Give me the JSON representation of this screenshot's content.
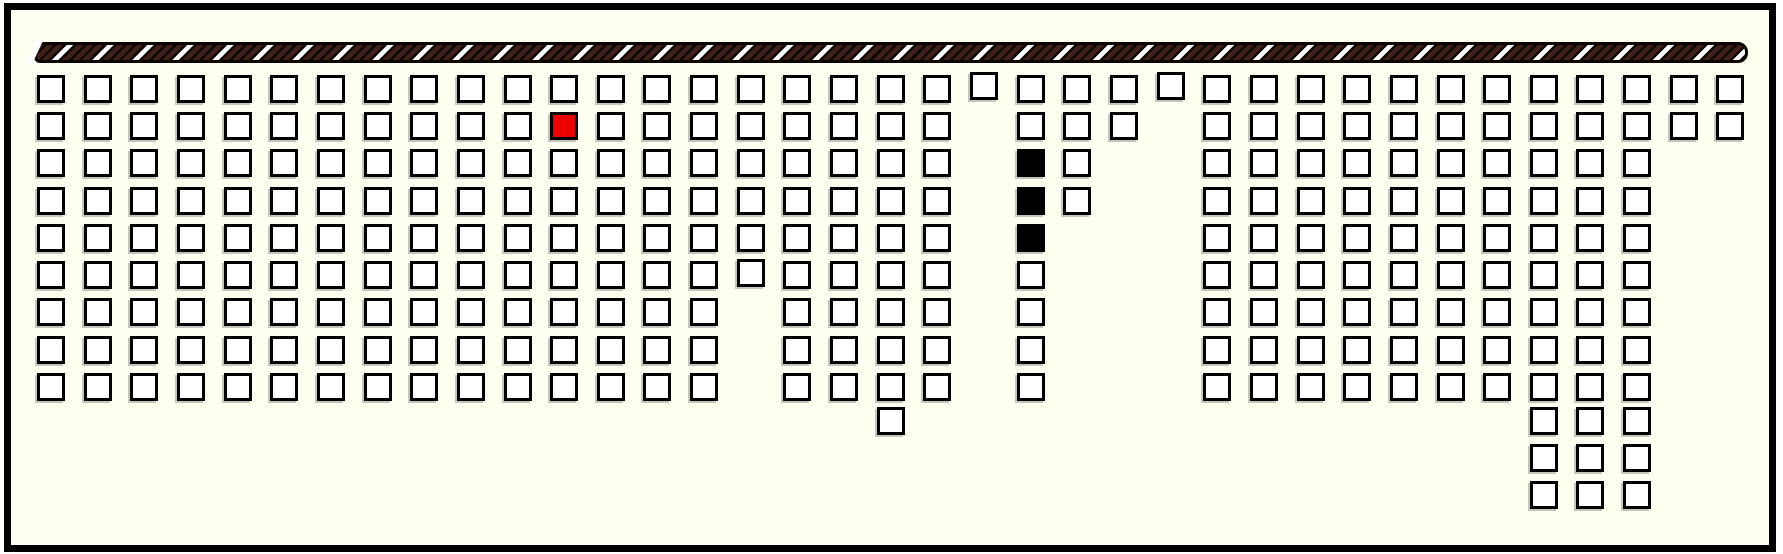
{
  "canvas": {
    "width": 1783,
    "height": 554,
    "outer_background": "#ffffff"
  },
  "frame": {
    "x": 4,
    "y": 3,
    "width": 1772,
    "height": 549,
    "border_color": "#000000",
    "border_width": 7,
    "fill": "#fffff1"
  },
  "hatched_bar": {
    "x": 34,
    "y": 42,
    "width": 1714,
    "height": 21,
    "background_black": "#0d0702",
    "stripe_brown": "#40201a",
    "stripe_white": "#ffffff",
    "border_color": "#0a0500",
    "stripe_angle_deg": 135,
    "start_wedge": {
      "x": 31,
      "y": 39,
      "color": "#ffffff"
    }
  },
  "grid": {
    "columns": 37,
    "origin_x": 37,
    "col_pitch": 46.65,
    "row_y": [
      75,
      112,
      149,
      187,
      224,
      261,
      298,
      336,
      373,
      407,
      444,
      481
    ],
    "cell_size": 28,
    "cell_border_width": 3.5,
    "cell_border": "#000000",
    "cell_fill": "#ffffff",
    "selected_fill": "#ee0000",
    "occupied_fill": "#000000",
    "rows": [
      {
        "row": 1,
        "ranges": [
          [
            1,
            37
          ]
        ]
      },
      {
        "row": 2,
        "ranges": [
          [
            1,
            20
          ],
          [
            22,
            24
          ],
          [
            26,
            37
          ]
        ]
      },
      {
        "row": 3,
        "ranges": [
          [
            1,
            20
          ],
          [
            22,
            23
          ],
          [
            26,
            35
          ]
        ]
      },
      {
        "row": 4,
        "ranges": [
          [
            1,
            20
          ],
          [
            22,
            23
          ],
          [
            26,
            35
          ]
        ]
      },
      {
        "row": 5,
        "ranges": [
          [
            1,
            20
          ],
          [
            22,
            22
          ],
          [
            26,
            35
          ]
        ]
      },
      {
        "row": 6,
        "ranges": [
          [
            1,
            20
          ],
          [
            22,
            22
          ],
          [
            26,
            35
          ]
        ]
      },
      {
        "row": 7,
        "ranges": [
          [
            1,
            15
          ],
          [
            17,
            20
          ],
          [
            22,
            22
          ],
          [
            26,
            35
          ]
        ]
      },
      {
        "row": 8,
        "ranges": [
          [
            1,
            15
          ],
          [
            17,
            20
          ],
          [
            22,
            22
          ],
          [
            26,
            35
          ]
        ]
      },
      {
        "row": 9,
        "ranges": [
          [
            1,
            15
          ],
          [
            17,
            20
          ],
          [
            22,
            22
          ],
          [
            26,
            35
          ]
        ]
      },
      {
        "row": 10,
        "ranges": [
          [
            19,
            19
          ],
          [
            33,
            35
          ]
        ]
      },
      {
        "row": 11,
        "ranges": [
          [
            33,
            35
          ]
        ]
      },
      {
        "row": 12,
        "ranges": [
          [
            33,
            35
          ]
        ]
      }
    ],
    "special_cells": [
      {
        "row": 2,
        "col": 12,
        "state": "selected"
      },
      {
        "row": 3,
        "col": 22,
        "state": "occupied"
      },
      {
        "row": 4,
        "col": 22,
        "state": "occupied"
      },
      {
        "row": 5,
        "col": 22,
        "state": "occupied"
      }
    ],
    "raised_cells": [
      {
        "row": 1,
        "col": 21,
        "dy": -3
      },
      {
        "row": 1,
        "col": 25,
        "dy": -3
      },
      {
        "row": 6,
        "col": 16,
        "dy": -2
      }
    ],
    "counts": {
      "total_slots": 298,
      "occupied": 3,
      "selected": 1
    }
  }
}
